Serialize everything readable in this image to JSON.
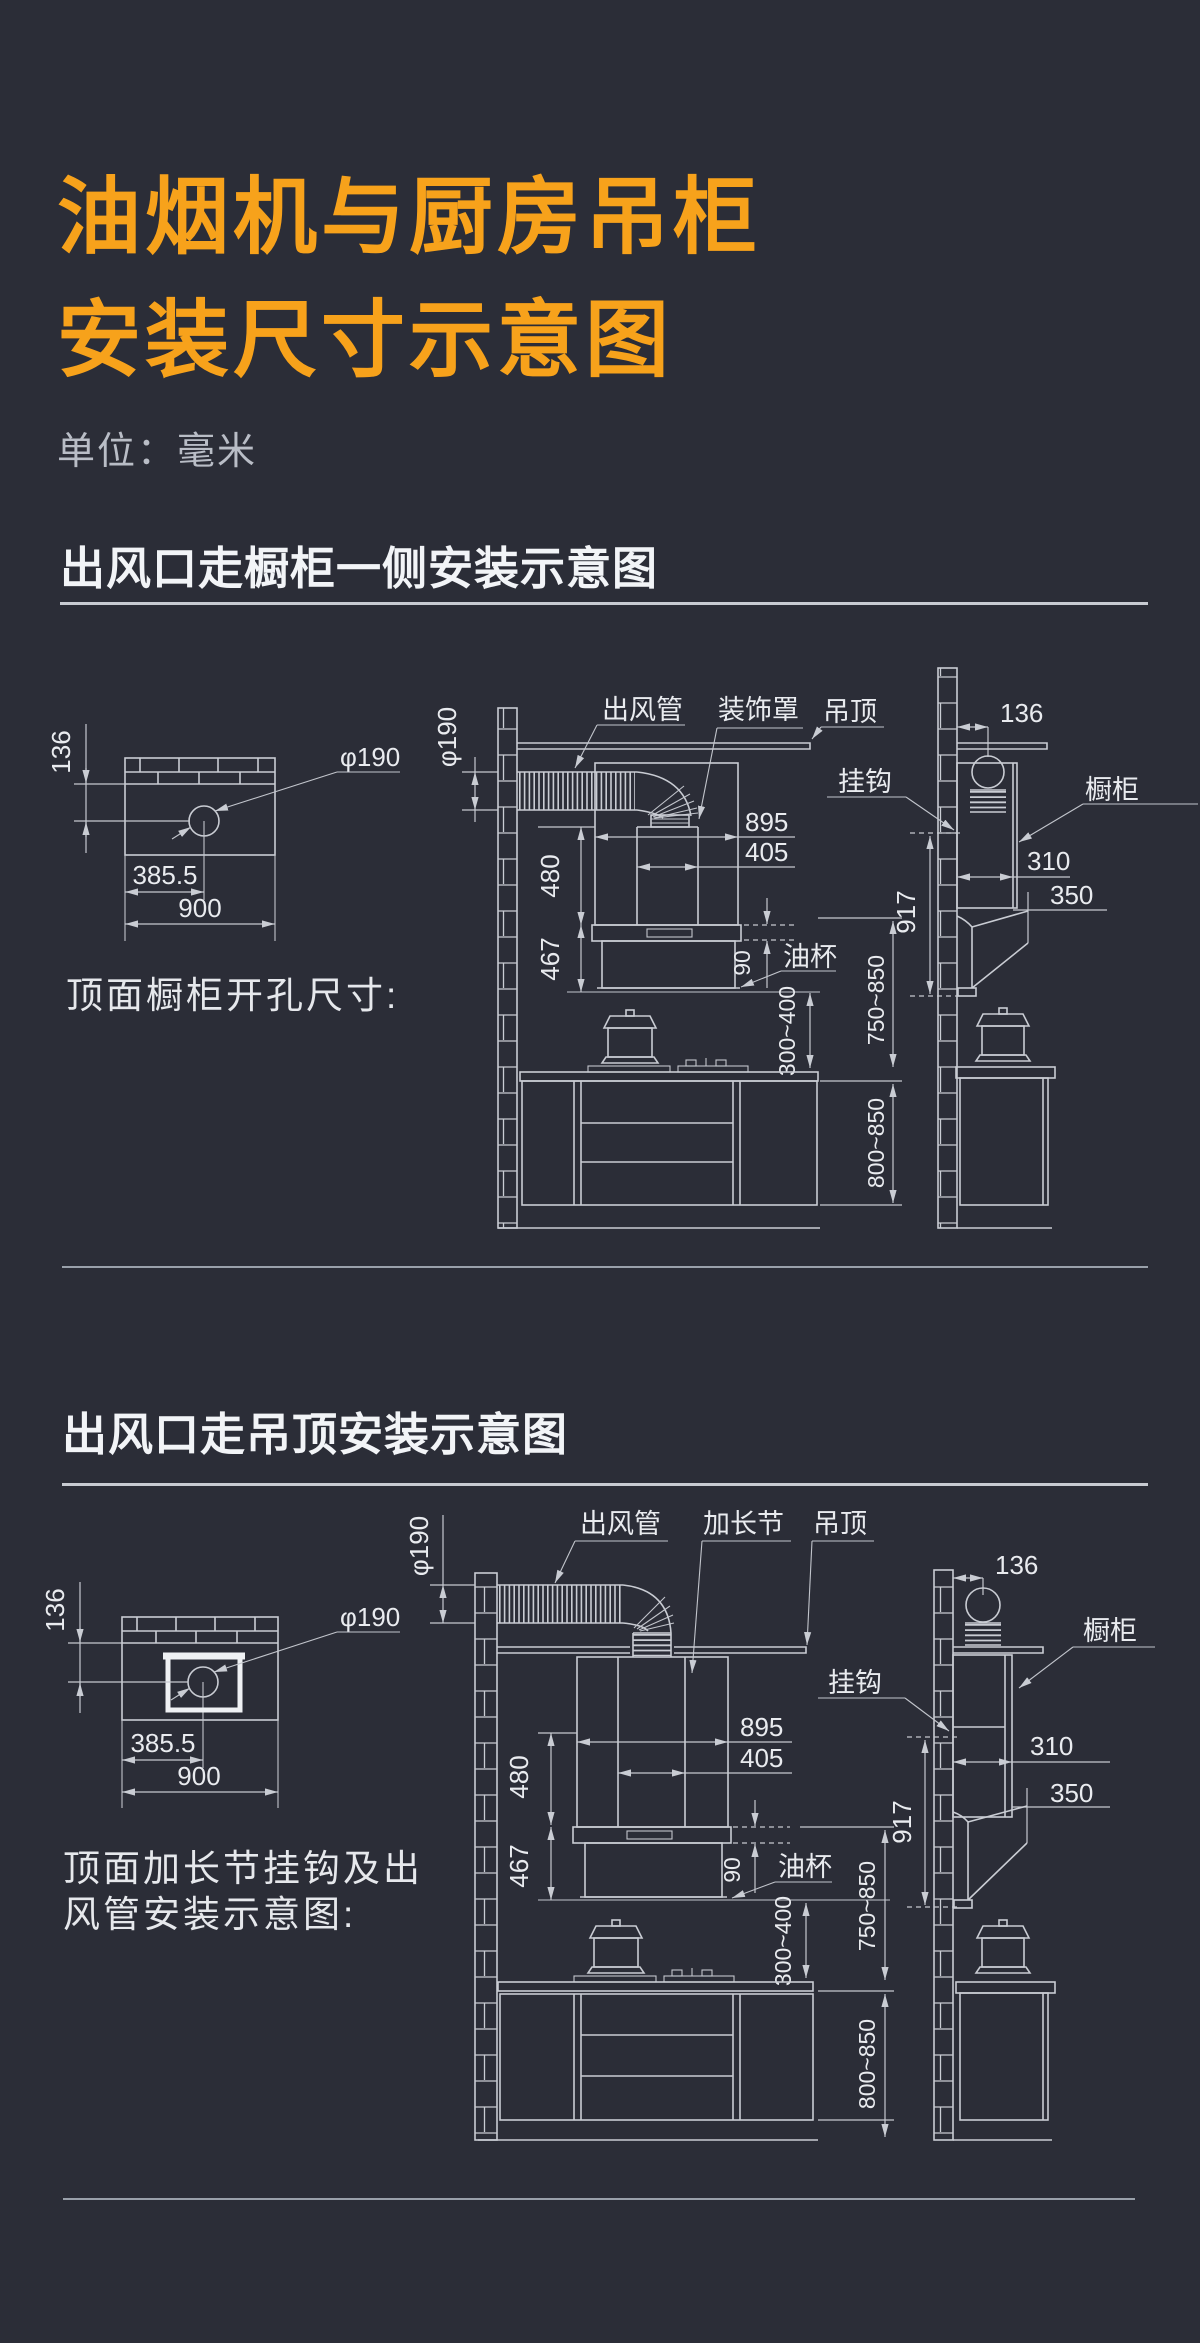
{
  "page": {
    "title_line1": "油烟机与厨房吊柜",
    "title_line2": "安装尺寸示意图",
    "unit": "单位：毫米"
  },
  "colors": {
    "background": "#2B2D37",
    "accent_orange": "#F7A21B",
    "heading_text": "#F2F4F7",
    "drawing_line": "#C9CCD3",
    "muted_text": "#B9BDC6"
  },
  "section1": {
    "heading": "出风口走橱柜一侧安装示意图",
    "caption": "顶面橱柜开孔尺寸:",
    "opening": {
      "offset_top": "136",
      "hole_dia": "φ190",
      "hole_center_x": "385.5",
      "width": "900"
    },
    "front": {
      "duct_dia": "φ190",
      "duct_label": "出风管",
      "cover_label": "装饰罩",
      "ceiling_label": "吊顶",
      "hood_width": "895",
      "outlet_width": "405",
      "cover_height": "480",
      "hood_height": "467",
      "cup_band": "90",
      "oil_cup_label": "油杯",
      "hood_to_counter": "300~400"
    },
    "side": {
      "wall_to_duct": "136",
      "hook_label": "挂钩",
      "cabinet_label": "橱柜",
      "cabinet_depth": "310",
      "hood_depth": "350",
      "hook_height": "917",
      "hood_bottom_range": "750~850",
      "counter_height": "800~850"
    }
  },
  "section2": {
    "heading": "出风口走吊顶安装示意图",
    "caption_line1": "顶面加长节挂钩及出",
    "caption_line2": "风管安装示意图:",
    "opening": {
      "offset_top": "136",
      "hole_dia": "φ190",
      "hole_center_x": "385.5",
      "width": "900"
    },
    "front": {
      "duct_dia": "φ190",
      "duct_label": "出风管",
      "extension_label": "加长节",
      "ceiling_label": "吊顶",
      "hood_width": "895",
      "outlet_width": "405",
      "cover_height": "480",
      "hood_height": "467",
      "cup_band": "90",
      "oil_cup_label": "油杯",
      "hood_to_counter": "300~400"
    },
    "side": {
      "wall_to_duct": "136",
      "hook_label": "挂钩",
      "cabinet_label": "橱柜",
      "cabinet_depth": "310",
      "hood_depth": "350",
      "hook_height": "917",
      "hood_bottom_range": "750~850",
      "counter_height": "800~850"
    }
  }
}
